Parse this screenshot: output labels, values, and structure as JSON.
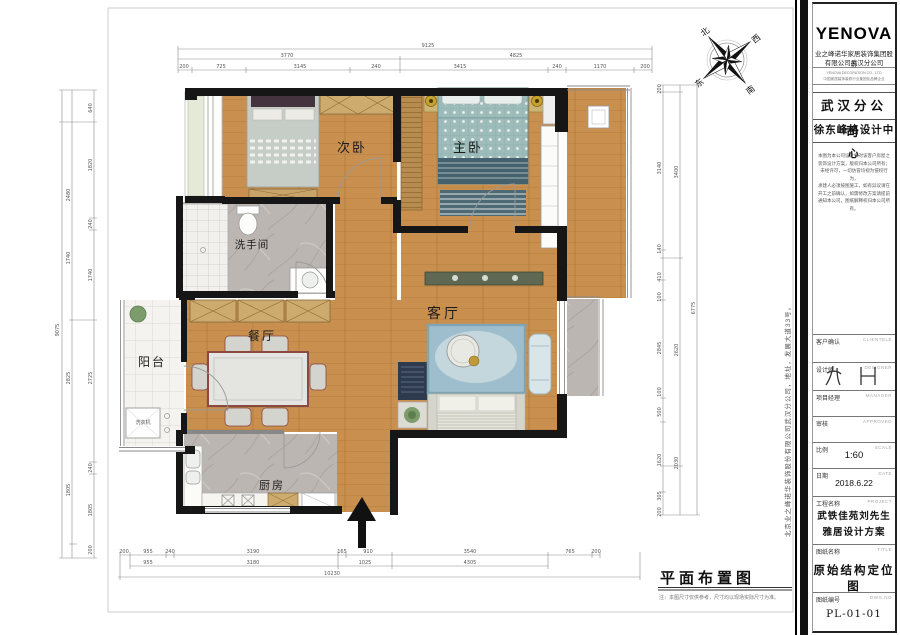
{
  "plan": {
    "rooms": {
      "secondary_bedroom": "次卧",
      "master_bedroom": "主卧",
      "bathroom": "洗手间",
      "living_room": "客厅",
      "dining_room": "餐厅",
      "balcony": "阳台",
      "kitchen": "厨房",
      "washer": "洗衣机"
    },
    "compass": {
      "north": "北",
      "south": "南",
      "east": "东",
      "west": "西"
    },
    "footer": {
      "title": "平面布置图",
      "note": "注：本图尺寸仅供参考，尺寸均以现场实际尺寸为准。"
    },
    "side_text": "北京业之峰诺华装饰股份有限公司武汉分公司，地址，发展大道33号。",
    "dims": {
      "top": {
        "total": "9125",
        "row2": [
          "3770",
          "4825"
        ],
        "row3": [
          "200",
          "725",
          "3145",
          "240",
          "3415",
          "240",
          "1170",
          "200"
        ]
      },
      "bottom": {
        "row1": [
          "200",
          "955",
          "240",
          "3190",
          "165",
          "910",
          "3540",
          "765",
          "200"
        ],
        "row2": [
          "955",
          "3180",
          "1025",
          "4305"
        ],
        "total": "10230"
      },
      "left": {
        "total": "9075",
        "outer": [
          "2480",
          "1740",
          "2825",
          "1805"
        ],
        "inner": [
          "640",
          "1820",
          "240",
          "1740",
          "2725",
          "240",
          "1805",
          "200"
        ]
      },
      "right": {
        "outer": [
          "200",
          "3140",
          "140",
          "410",
          "100",
          "2845",
          "100",
          "500",
          "1620",
          "305",
          "200"
        ],
        "mid": [
          "3400",
          "2620",
          "2030"
        ],
        "total": "6775"
      }
    }
  },
  "titleblock": {
    "logo": "YENOVA",
    "company_cn_1": "业之峰诺华家居装饰集团股份",
    "company_cn_2": "有限公司武汉分公司",
    "company_en": "YENOVA DECORATION CO., LTD",
    "company_sub": "中国家居装饰装修行业集团化品牌企业",
    "branch": "武汉分公司",
    "design_center": "徐东峰格设计中心",
    "disclaimer": [
      "本图为本公司设计师对该客户房屋之",
      "装饰设计方案，版权归本公司所有；",
      "未经许可，一切仿冒均视为侵权行为，",
      "承建人必须按图施工，如有异议请在",
      "开工之前确认，如需修改方案请提前",
      "通知本公司，图纸解释权归本公司所有。"
    ],
    "fields": {
      "client_label": "客户确认",
      "client_en": "CLIENTELE",
      "designer_label": "设计师",
      "designer_en": "DESIGNER",
      "manager_label": "项目经理",
      "manager_en": "MANAGER",
      "approved_label": "审核",
      "approved_en": "APPROVED",
      "scale_label": "比例",
      "scale_en": "SCALE",
      "scale_value": "1:60",
      "date_label": "日期",
      "date_en": "DATE",
      "date_value": "2018.6.22",
      "project_label": "工程名称",
      "project_en": "PROJECT",
      "project_value_1": "武铁佳苑刘先生",
      "project_value_2": "雅居设计方案",
      "title_label": "图纸名称",
      "title_en": "TITLE",
      "title_value": "原始结构定位图",
      "no_label": "图纸编号",
      "no_en": "DWG.NO",
      "no_value": "PL-01-01"
    }
  }
}
